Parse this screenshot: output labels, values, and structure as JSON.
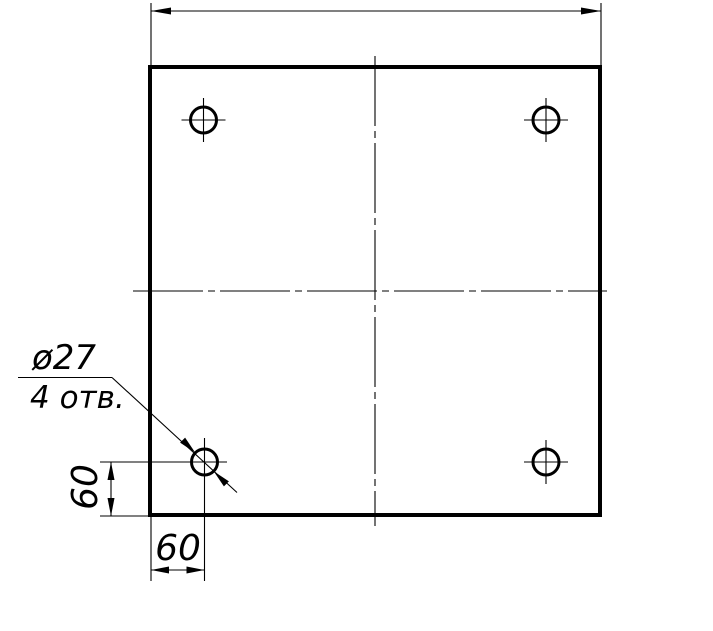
{
  "drawing": {
    "type": "engineering-drawing",
    "view": "square plate, front view, 4 drilled holes",
    "colors": {
      "line": "#000000",
      "background": "#ffffff"
    },
    "annotations": {
      "hole_diameter_label": "ø27",
      "hole_count_label": "4 отв.",
      "vertical_offset_label": "60",
      "horizontal_offset_label": "60"
    }
  }
}
